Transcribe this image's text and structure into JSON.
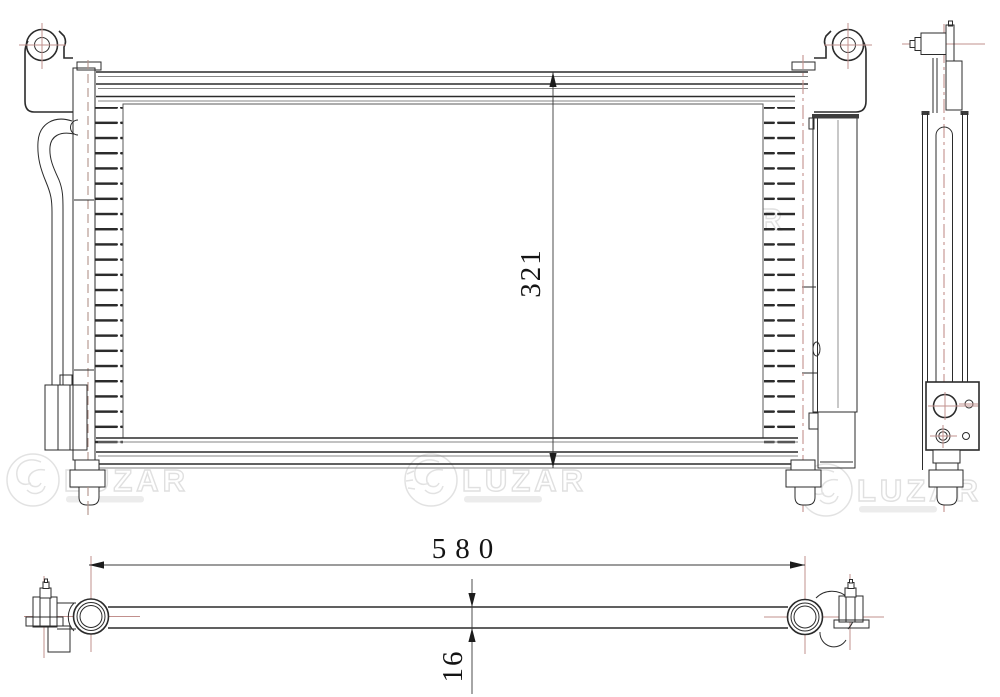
{
  "drawing": {
    "type": "technical-drawing",
    "subject": "automotive air-conditioning condenser, three orthographic views"
  },
  "dimensions": {
    "core_height": {
      "value": "321"
    },
    "core_width": {
      "value": "580"
    },
    "core_thickness": {
      "value": "16"
    }
  },
  "watermark": {
    "brand": "LUZAR",
    "emblem": "luzar-dragon-emblem"
  },
  "colors": {
    "background": "#ffffff",
    "line": "#2b2b2b",
    "line_light": "#858585",
    "centerline": "#c2908d",
    "dimension_text": "#141414",
    "watermark": "#e2e2e2"
  }
}
